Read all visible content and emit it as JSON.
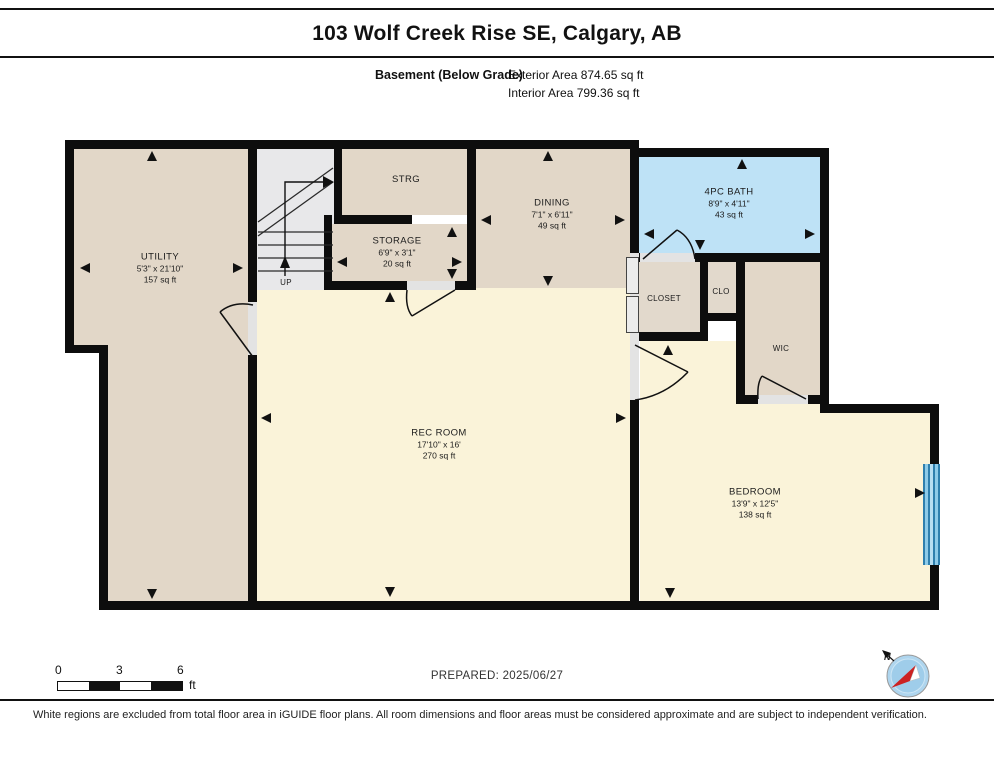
{
  "header": {
    "title": "103 Wolf Creek Rise SE, Calgary, AB",
    "floor_label": "Basement (Below Grade)",
    "exterior_area": "Exterior Area 874.65 sq ft",
    "interior_area": "Interior Area 799.36 sq ft"
  },
  "rooms": {
    "utility": {
      "name": "UTILITY",
      "dims": "5'3\" x 21'10\"",
      "area": "157 sq ft"
    },
    "strg": {
      "name": "STRG"
    },
    "storage": {
      "name": "STORAGE",
      "dims": "6'9\" x 3'1\"",
      "area": "20 sq ft"
    },
    "dining": {
      "name": "DINING",
      "dims": "7'1\" x 6'11\"",
      "area": "49 sq ft"
    },
    "bath": {
      "name": "4PC BATH",
      "dims": "8'9\" x 4'11\"",
      "area": "43 sq ft"
    },
    "closet": {
      "name": "CLOSET"
    },
    "clo": {
      "name": "CLO"
    },
    "wic": {
      "name": "WIC"
    },
    "rec_room": {
      "name": "REC ROOM",
      "dims": "17'10\" x 16'",
      "area": "270 sq ft"
    },
    "bedroom": {
      "name": "BEDROOM",
      "dims": "13'9\" x 12'5\"",
      "area": "138 sq ft"
    }
  },
  "stairs": {
    "label": "UP"
  },
  "footer": {
    "scale": {
      "ticks": [
        "0",
        "3",
        "6"
      ],
      "unit": "ft"
    },
    "prepared": "PREPARED: 2025/06/27",
    "compass_label": "N",
    "disclaimer": "White regions are excluded from total floor area in iGUIDE floor plans. All room dimensions and floor areas must be considered approximate and are subject to independent verification."
  },
  "colors": {
    "wall": "#0d0d0d",
    "room_beige": "#e2d7c8",
    "room_yellow": "#faf3d9",
    "bath_blue": "#bee2f6",
    "stairs_gray": "#e8e8ea",
    "window_blue": "#4fa8d6"
  }
}
